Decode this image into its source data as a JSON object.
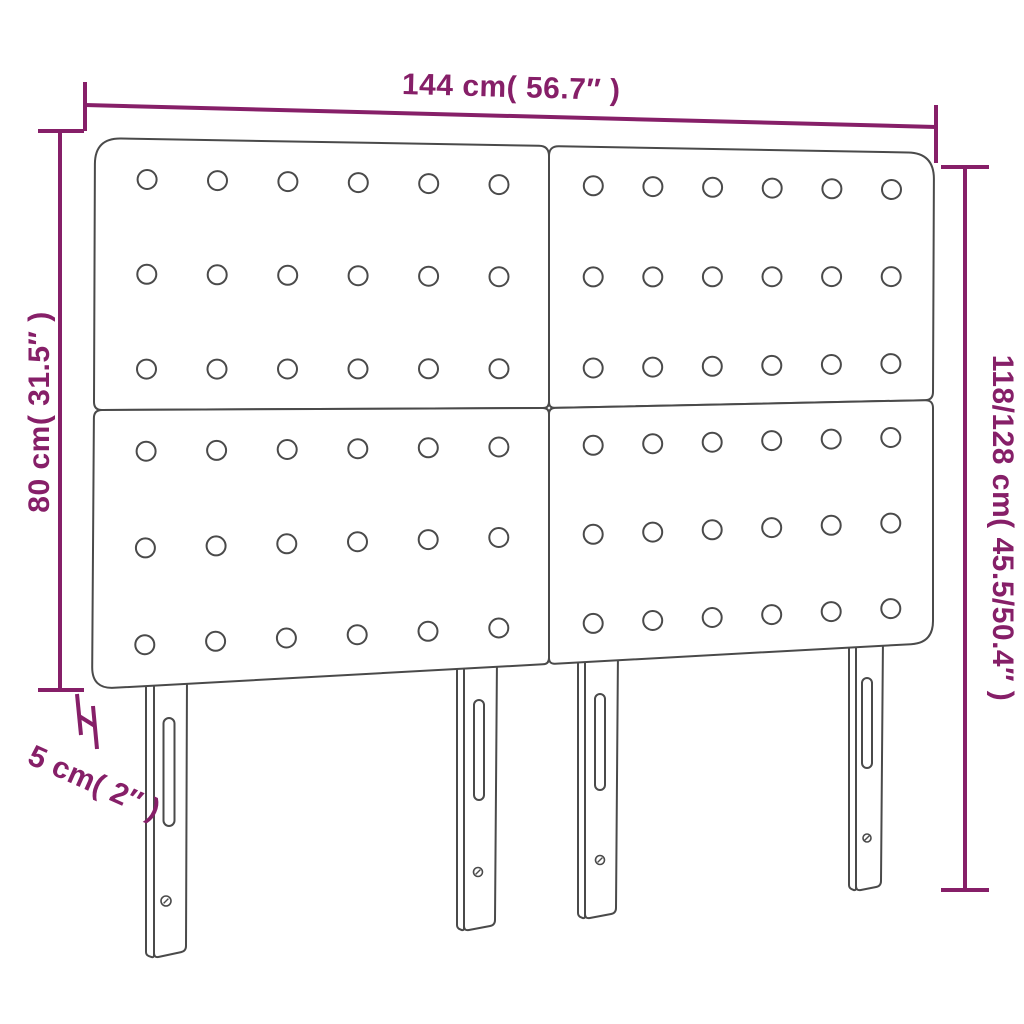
{
  "diagram": {
    "type": "product-dimension-diagram",
    "subject": "tufted headboard with 4 panels and 4 slotted legs"
  },
  "colors": {
    "dimension": "#861F68",
    "outline": "#4A4A4A",
    "background": "#FFFFFF"
  },
  "dimensions": {
    "width": {
      "label": "144 cm( 56.7″ )"
    },
    "height_panel": {
      "label": "80 cm( 31.5″ )"
    },
    "height_total": {
      "label": "118/128 cm( 45.5/50.4″ )"
    },
    "depth": {
      "label": "5 cm( 2″ )"
    }
  },
  "structure": {
    "panel_count": 4,
    "button_rows_per_panel": 3,
    "button_cols_per_panel": 6,
    "leg_count": 4
  }
}
